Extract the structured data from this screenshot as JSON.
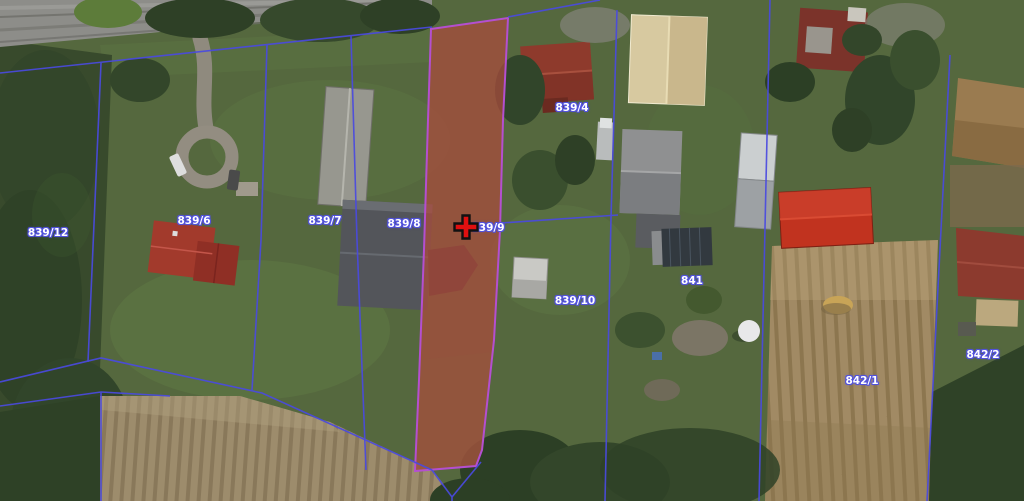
{
  "map": {
    "type": "aerial-cadastral-view",
    "selected_parcel": "839/9",
    "marker": {
      "type": "cross",
      "x": 466,
      "y": 227
    },
    "parcel_labels": [
      {
        "text": "839/12",
        "x": 48,
        "y": 233
      },
      {
        "text": "839/6",
        "x": 194,
        "y": 221
      },
      {
        "text": "839/7",
        "x": 325,
        "y": 221
      },
      {
        "text": "839/8",
        "x": 404,
        "y": 224
      },
      {
        "text": "839/9",
        "x": 488,
        "y": 228
      },
      {
        "text": "839/4",
        "x": 572,
        "y": 108
      },
      {
        "text": "839/10",
        "x": 575,
        "y": 301
      },
      {
        "text": "841",
        "x": 692,
        "y": 281
      },
      {
        "text": "842/1",
        "x": 862,
        "y": 381
      },
      {
        "text": "842/2",
        "x": 983,
        "y": 355
      }
    ],
    "colors": {
      "boundary_line": "#4a4ae0",
      "label_text": "#ffffff",
      "label_halo": "#5252dd",
      "selected_fill": "rgba(198,38,32,0.40)",
      "selected_border": "#b44fd0",
      "marker_red": "#e01010",
      "marker_outline": "#111111"
    }
  }
}
